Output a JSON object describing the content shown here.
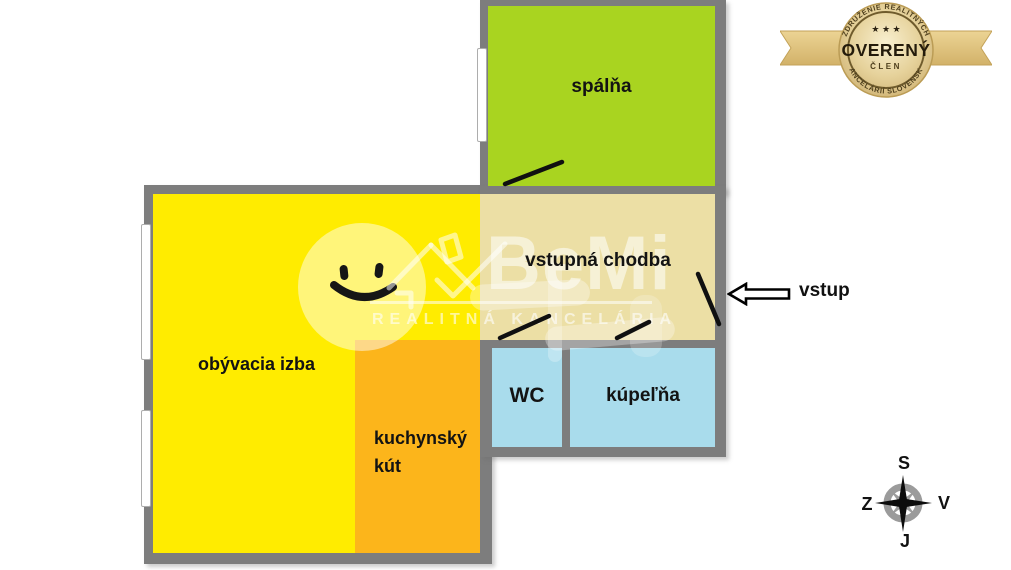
{
  "floorplan": {
    "wall_color": "#7d7d7d",
    "rooms": {
      "bedroom": {
        "label": "spálňa",
        "color": "#a9d420"
      },
      "hall": {
        "label": "vstupná chodba",
        "color": "#ecdfa5"
      },
      "living": {
        "label": "obývacia izba",
        "color": "#ffec00"
      },
      "kitchen": {
        "label_line1": "kuchynský",
        "label_line2": "kút",
        "color": "#fcb51b"
      },
      "wc": {
        "label": "WC",
        "color": "#a9dcec"
      },
      "bathroom": {
        "label": "kúpeľňa",
        "color": "#a9dcec"
      }
    },
    "entrance": {
      "label": "vstup"
    }
  },
  "compass": {
    "north_label": "S",
    "south_label": "J",
    "west_label": "Z",
    "east_label": "V"
  },
  "badge": {
    "arc_top": "ZDRUŽENIE REALITNÝCH",
    "arc_bottom": "KANCELÁRIÍ SLOVENSKA",
    "title": "OVERENÝ",
    "subtitle": "ČLEN",
    "stars": "★ ★ ★",
    "gold_color": "#d9bf7e"
  },
  "watermark": {
    "brand": "BeMi",
    "tagline": "REALITNÁ KANCELÁRIA"
  }
}
